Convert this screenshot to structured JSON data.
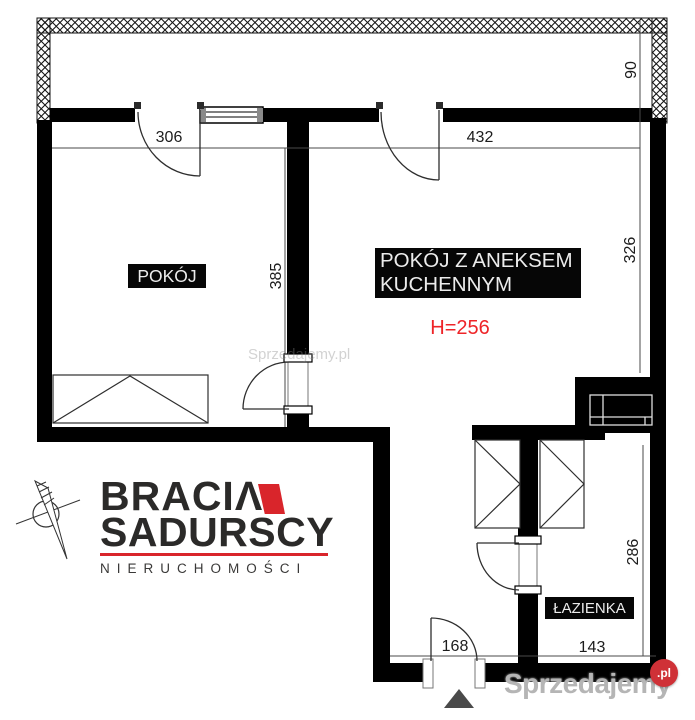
{
  "plan": {
    "rooms": [
      {
        "id": "pokoj",
        "label": "POKÓJ"
      },
      {
        "id": "pokoj-z-aneksem",
        "label_line1": "POKÓJ Z ANEKSEM",
        "label_line2": "KUCHENNYM",
        "height_note": "H=256"
      },
      {
        "id": "lazienka",
        "label": "ŁAZIENKA"
      }
    ],
    "dimensions": {
      "pokoj_width": "306",
      "kitchen_width": "432",
      "balcony_depth": "90",
      "kitchen_height": "326",
      "pokoj_height": "385",
      "hall_height": "286",
      "bathroom_width": "143",
      "entry_width": "168"
    },
    "colors": {
      "wall": "#000000",
      "height_note_red": "#ee2428",
      "line": "#4a4a4a"
    }
  },
  "branding": {
    "agency_line1": "BRACIΛ",
    "agency_line2": "SADURSCY",
    "tagline": "NIERUCHOMOŚCI",
    "accent_red": "#d9252b"
  },
  "watermark": {
    "site_name": "Sprzedajemy",
    "site_tld": ".pl",
    "faint_text": "Sprzedajemy.pl"
  }
}
